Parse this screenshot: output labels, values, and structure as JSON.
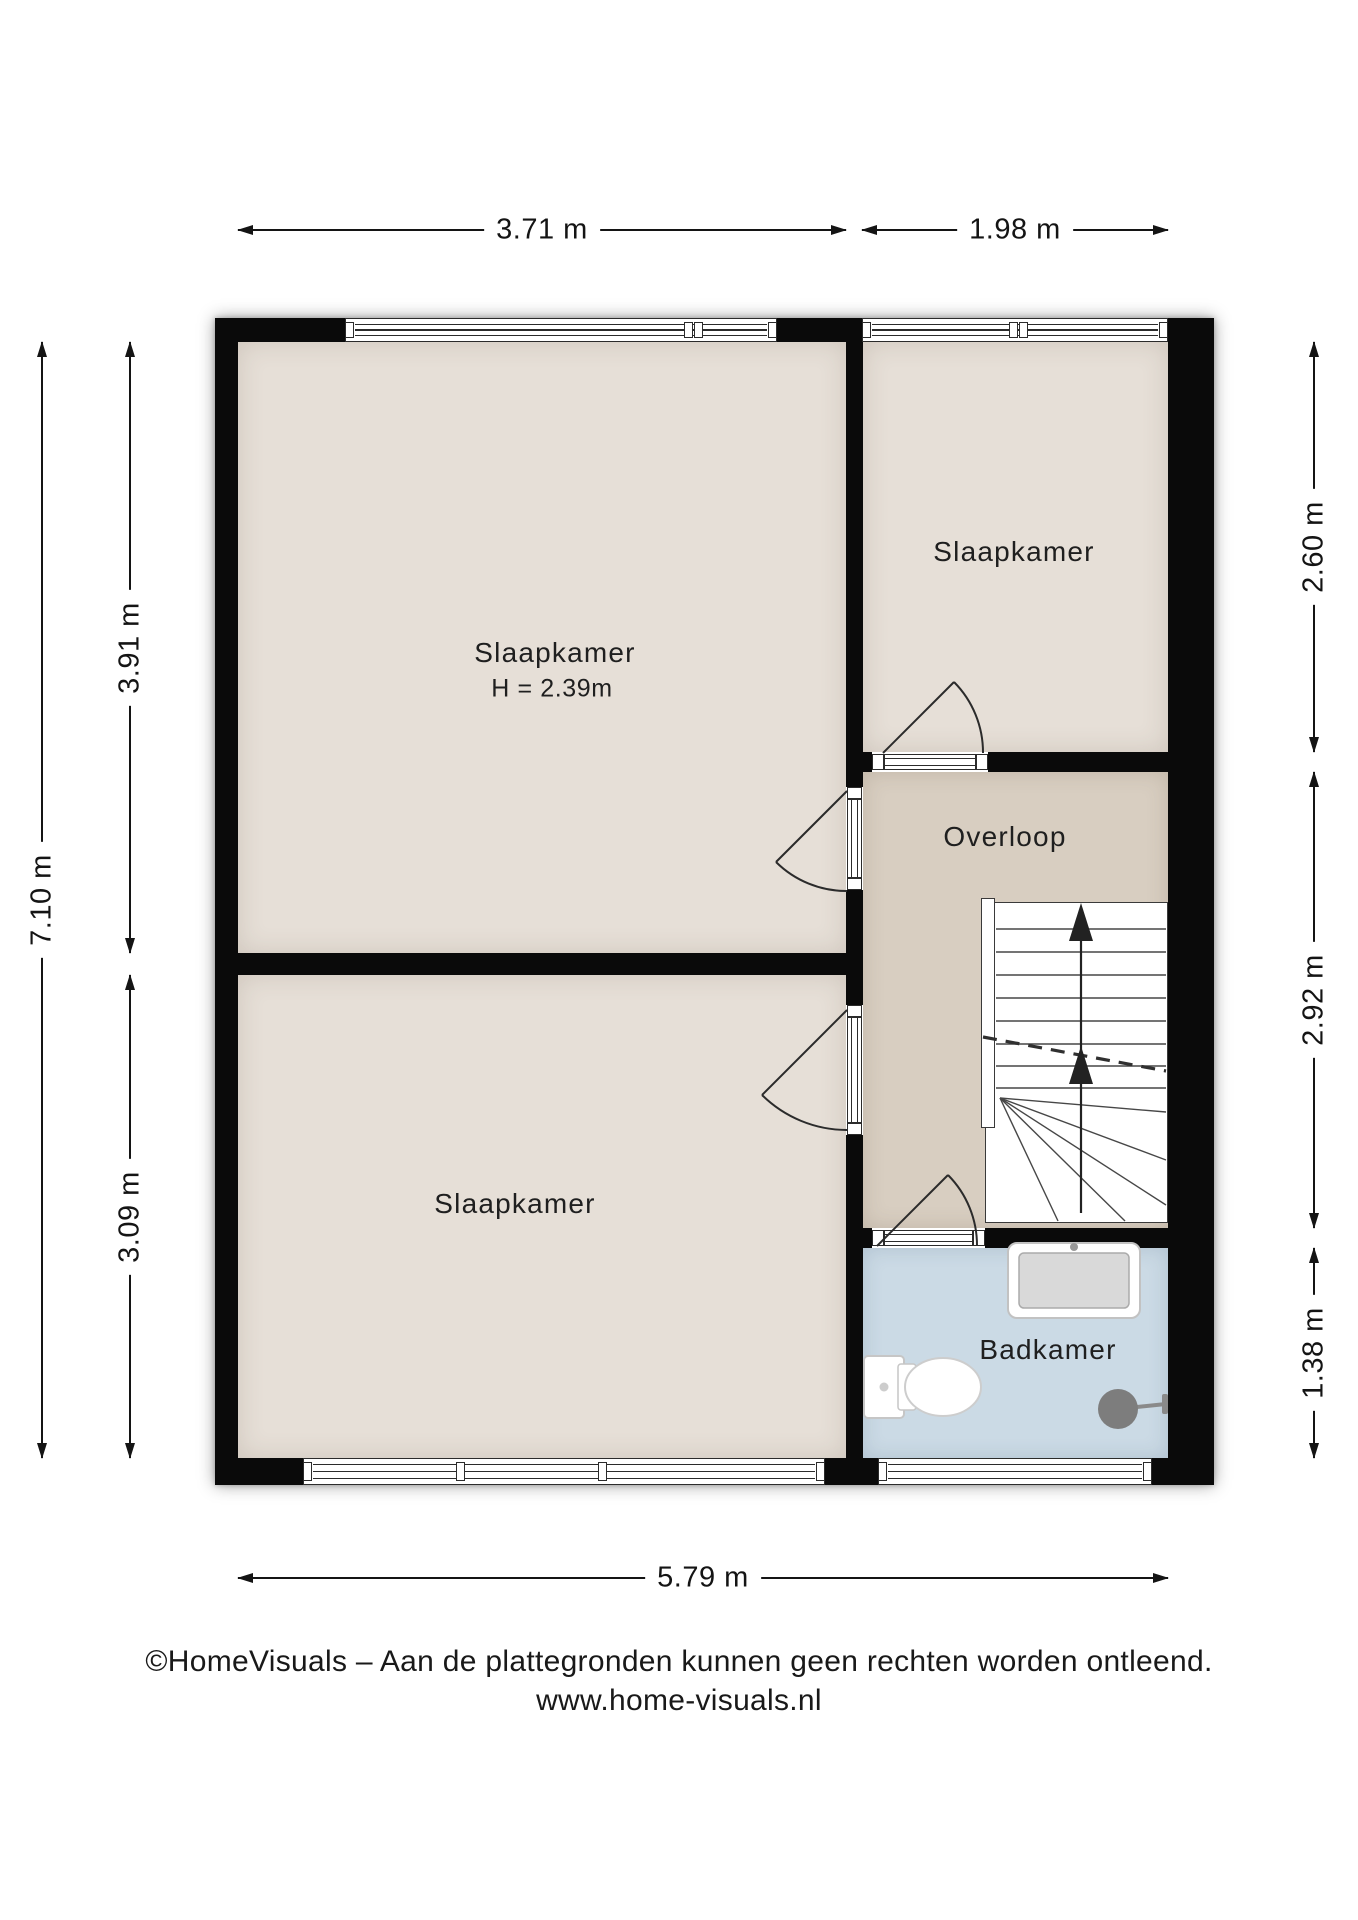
{
  "page": {
    "width": 1358,
    "height": 1920,
    "background": "#ffffff"
  },
  "colors": {
    "wall": "#0a0a0a",
    "bedroom_floor": "#e6dfd7",
    "landing_floor": "#d8cec1",
    "bathroom_floor": "#cbdae5",
    "line": "#2b2b2b",
    "text": "#1e1e1e",
    "fixture": "#7d7d7d",
    "fixture_stroke": "#c6c6c6"
  },
  "rooms": {
    "bedroom_main": {
      "label": "Slaapkamer",
      "ceiling_height": "H = 2.39m"
    },
    "bedroom_top_right": {
      "label": "Slaapkamer"
    },
    "landing": {
      "label": "Overloop"
    },
    "bedroom_bottom": {
      "label": "Slaapkamer"
    },
    "bathroom": {
      "label": "Badkamer"
    }
  },
  "dimensions": {
    "top_left": "3.71 m",
    "top_right": "1.98 m",
    "left_total": "7.10 m",
    "left_upper": "3.91 m",
    "left_lower": "3.09 m",
    "right_upper": "2.60 m",
    "right_middle": "2.92 m",
    "right_lower": "1.38 m",
    "bottom_total": "5.79 m"
  },
  "fixtures": {
    "stairs": "stairs-up",
    "bathtub": "bathtub",
    "toilet": "toilet",
    "shower": "shower-head"
  },
  "footer": {
    "line1": "©HomeVisuals – Aan de plattegronden kunnen geen rechten worden ontleend.",
    "line2": "www.home-visuals.nl"
  }
}
